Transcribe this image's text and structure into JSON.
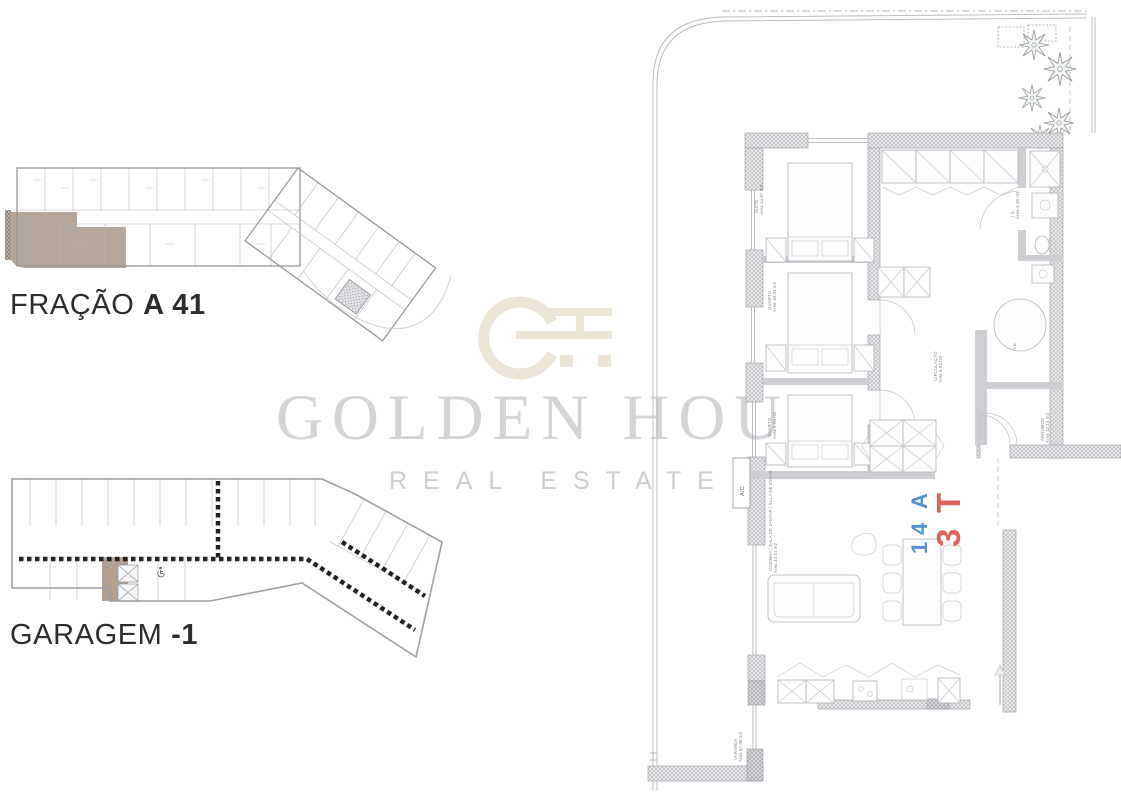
{
  "headings": {
    "fracao_label": "FRAÇÃO",
    "fracao_unit": "A 41",
    "garagem_label": "GARAGEM",
    "garagem_level": "-1"
  },
  "watermark": {
    "brand_name": "GOLDEN HOUR",
    "brand_tagline": "REAL ESTATE"
  },
  "colors": {
    "highlight_brown": "#b2a193",
    "unit_type_red": "#e2635b",
    "unit_code_blue": "#4e90d2",
    "brand_serif_gray": "#d3d3d8",
    "brand_sans_gray": "#cbcbd1",
    "logo_beige": "#ece5d5",
    "lane_marking_black": "#222222"
  },
  "apartment": {
    "unit_type_chars": [
      "T",
      "3"
    ],
    "unit_code_chars": [
      "A",
      "4",
      "1"
    ],
    "labels": {
      "suite": {
        "name": "SUITE",
        "area": "Área 14,87 m2"
      },
      "quarto1": {
        "name": "QUARTO",
        "area": "Área 10,34 m2"
      },
      "quarto2": {
        "name": "QUARTO",
        "area": "Área 9,98 m2"
      },
      "circulacao": {
        "name": "CIRCULAÇÃO",
        "area": "Área 5,92 m2"
      },
      "is_suite": {
        "name": "I.S.",
        "area": "Área 4,48 m2"
      },
      "is_main": {
        "name": "I.S."
      },
      "arrumos": {
        "name": "ARRUMOS",
        "area": "Área 12,14 m2"
      },
      "living": {
        "name": "COZINHA | SALA DE JANTAR | SALA DE ESTAR",
        "area": "Área 34,51 m2"
      },
      "varanda": {
        "name": "VARANDA",
        "area": "Área 67,00 m2"
      },
      "ac": {
        "name": "A/C"
      }
    }
  }
}
